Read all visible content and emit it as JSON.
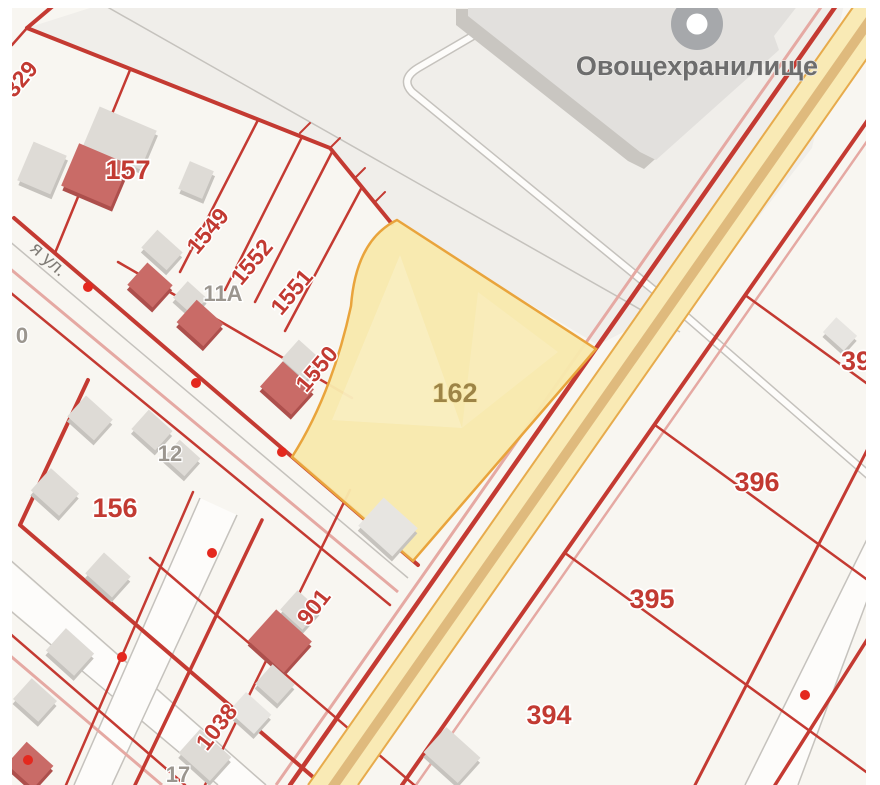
{
  "map": {
    "type": "cadastral-map",
    "building_label": "Овощехранилище",
    "selected_parcel": "162"
  },
  "colors": {
    "frame": "#ffffff",
    "mapBg": "#f8f6f1",
    "zone": "#f0eeea",
    "red": "#c43a32",
    "pink": "#e5a9a3",
    "grayLine": "#c5c2bd",
    "roadWhite": "#fdfcfa",
    "roadYellow": "#f9eab5",
    "roadStripe": "#dfba7d",
    "roadEdge": "#e7ab4c",
    "parcelFill": "#f8e9ad",
    "parcelEdge": "#e9a43c",
    "bldGray": "#dedbd6",
    "bldGrayShadow": "#c6c3be",
    "bldGrayLight": "#e7e5e1",
    "bldRed": "#c96b67",
    "bldRedShadow": "#ad4f4c",
    "bigBldFace": "#e2e0dd",
    "bigBldSide": "#c9c6c1",
    "iconGray": "#a6a8ab",
    "dotRed": "#e4281e",
    "lblRed": "#c23a32",
    "lblGray": "#9b968f",
    "lblBrown": "#9d8446",
    "lblStreet": "#807c76",
    "lblBld": "#6d6d6d"
  },
  "labels": [
    {
      "text": "329",
      "x": 22,
      "y": 80,
      "rot": -50,
      "cls": "lbl-red",
      "name": "parcel-label-329"
    },
    {
      "text": "157",
      "x": 128,
      "y": 172,
      "rot": 0,
      "cls": "lbl-red-lg",
      "name": "parcel-label-157"
    },
    {
      "text": "1549",
      "x": 209,
      "y": 232,
      "rot": -50,
      "cls": "lbl-red",
      "name": "parcel-label-1549"
    },
    {
      "text": "1552",
      "x": 253,
      "y": 263,
      "rot": -50,
      "cls": "lbl-red",
      "name": "parcel-label-1552"
    },
    {
      "text": "1551",
      "x": 293,
      "y": 293,
      "rot": -50,
      "cls": "lbl-red",
      "name": "parcel-label-1551"
    },
    {
      "text": "1550",
      "x": 318,
      "y": 370,
      "rot": -50,
      "cls": "lbl-red",
      "name": "parcel-label-1550"
    },
    {
      "text": "11А",
      "x": 223,
      "y": 295,
      "rot": 0,
      "cls": "lbl-gray",
      "name": "address-label-11a"
    },
    {
      "text": "12",
      "x": 170,
      "y": 455,
      "rot": 0,
      "cls": "lbl-gray",
      "name": "address-label-12"
    },
    {
      "text": "0",
      "x": 22,
      "y": 337,
      "rot": 0,
      "cls": "lbl-gray",
      "name": "address-label-0"
    },
    {
      "text": "156",
      "x": 115,
      "y": 510,
      "rot": 0,
      "cls": "lbl-red-lg",
      "name": "parcel-label-156"
    },
    {
      "text": "я ул.",
      "x": 48,
      "y": 260,
      "rot": 42,
      "cls": "lbl-street",
      "name": "street-name-label"
    },
    {
      "text": "162",
      "x": 455,
      "y": 395,
      "rot": 0,
      "cls": "lbl-brown",
      "name": "selected-parcel-label-162"
    },
    {
      "text": "Овощехранилище",
      "x": 697,
      "y": 68,
      "rot": 0,
      "cls": "lbl-bld",
      "name": "building-name-label"
    },
    {
      "text": "901",
      "x": 315,
      "y": 608,
      "rot": -52,
      "cls": "lbl-red",
      "name": "parcel-label-901"
    },
    {
      "text": "1038",
      "x": 218,
      "y": 728,
      "rot": -52,
      "cls": "lbl-red",
      "name": "parcel-label-1038"
    },
    {
      "text": "17",
      "x": 178,
      "y": 776,
      "rot": 0,
      "cls": "lbl-gray",
      "name": "address-label-17"
    },
    {
      "text": "396",
      "x": 757,
      "y": 484,
      "rot": 0,
      "cls": "lbl-red-lg",
      "name": "parcel-label-396"
    },
    {
      "text": "395",
      "x": 652,
      "y": 601,
      "rot": 0,
      "cls": "lbl-red-lg",
      "name": "parcel-label-395"
    },
    {
      "text": "394",
      "x": 549,
      "y": 717,
      "rot": 0,
      "cls": "lbl-red-lg",
      "name": "parcel-label-394"
    },
    {
      "text": "39",
      "x": 856,
      "y": 363,
      "rot": 0,
      "cls": "lbl-red-lg",
      "name": "parcel-label-39x"
    }
  ],
  "dots": [
    {
      "x": 88,
      "y": 287
    },
    {
      "x": 282,
      "y": 452
    },
    {
      "x": 196,
      "y": 383
    },
    {
      "x": 122,
      "y": 657
    },
    {
      "x": 212,
      "y": 553
    },
    {
      "x": 28,
      "y": 760
    },
    {
      "x": 805,
      "y": 695
    }
  ],
  "buildings": [
    {
      "x": 120,
      "y": 138,
      "w": 62,
      "h": 42,
      "rot": 23,
      "t": "g"
    },
    {
      "x": 42,
      "y": 168,
      "w": 36,
      "h": 42,
      "rot": 23,
      "t": "g"
    },
    {
      "x": 196,
      "y": 180,
      "w": 26,
      "h": 30,
      "rot": 23,
      "t": "g"
    },
    {
      "x": 95,
      "y": 175,
      "w": 54,
      "h": 46,
      "rot": 23,
      "t": "r"
    },
    {
      "x": 162,
      "y": 250,
      "w": 34,
      "h": 24,
      "rot": 42,
      "t": "g"
    },
    {
      "x": 150,
      "y": 285,
      "w": 34,
      "h": 30,
      "rot": 42,
      "t": "r"
    },
    {
      "x": 190,
      "y": 298,
      "w": 26,
      "h": 22,
      "rot": 42,
      "t": "g"
    },
    {
      "x": 200,
      "y": 323,
      "w": 36,
      "h": 30,
      "rot": 42,
      "t": "r"
    },
    {
      "x": 302,
      "y": 360,
      "w": 32,
      "h": 26,
      "rot": 42,
      "t": "g"
    },
    {
      "x": 287,
      "y": 388,
      "w": 42,
      "h": 34,
      "rot": 42,
      "t": "r"
    },
    {
      "x": 90,
      "y": 418,
      "w": 36,
      "h": 28,
      "rot": 42,
      "t": "g"
    },
    {
      "x": 55,
      "y": 492,
      "w": 38,
      "h": 30,
      "rot": 42,
      "t": "g"
    },
    {
      "x": 152,
      "y": 430,
      "w": 32,
      "h": 26,
      "rot": 42,
      "t": "g"
    },
    {
      "x": 182,
      "y": 458,
      "w": 28,
      "h": 24,
      "rot": 42,
      "t": "g"
    },
    {
      "x": 108,
      "y": 575,
      "w": 36,
      "h": 28,
      "rot": 42,
      "t": "g"
    },
    {
      "x": 70,
      "y": 652,
      "w": 38,
      "h": 30,
      "rot": 42,
      "t": "g"
    },
    {
      "x": 35,
      "y": 700,
      "w": 34,
      "h": 28,
      "rot": 42,
      "t": "g"
    },
    {
      "x": 388,
      "y": 527,
      "w": 46,
      "h": 38,
      "rot": 42,
      "t": "gl"
    },
    {
      "x": 300,
      "y": 610,
      "w": 30,
      "h": 26,
      "rot": 42,
      "t": "g"
    },
    {
      "x": 280,
      "y": 641,
      "w": 48,
      "h": 42,
      "rot": 42,
      "t": "r"
    },
    {
      "x": 275,
      "y": 684,
      "w": 30,
      "h": 26,
      "rot": 42,
      "t": "g"
    },
    {
      "x": 205,
      "y": 755,
      "w": 42,
      "h": 32,
      "rot": 42,
      "t": "g"
    },
    {
      "x": 250,
      "y": 713,
      "w": 34,
      "h": 26,
      "rot": 42,
      "t": "gl"
    },
    {
      "x": 452,
      "y": 755,
      "w": 46,
      "h": 34,
      "rot": 42,
      "t": "g"
    },
    {
      "x": 840,
      "y": 334,
      "w": 28,
      "h": 20,
      "rot": 42,
      "t": "gl"
    },
    {
      "x": 30,
      "y": 765,
      "w": 36,
      "h": 30,
      "rot": 42,
      "t": "r"
    }
  ]
}
